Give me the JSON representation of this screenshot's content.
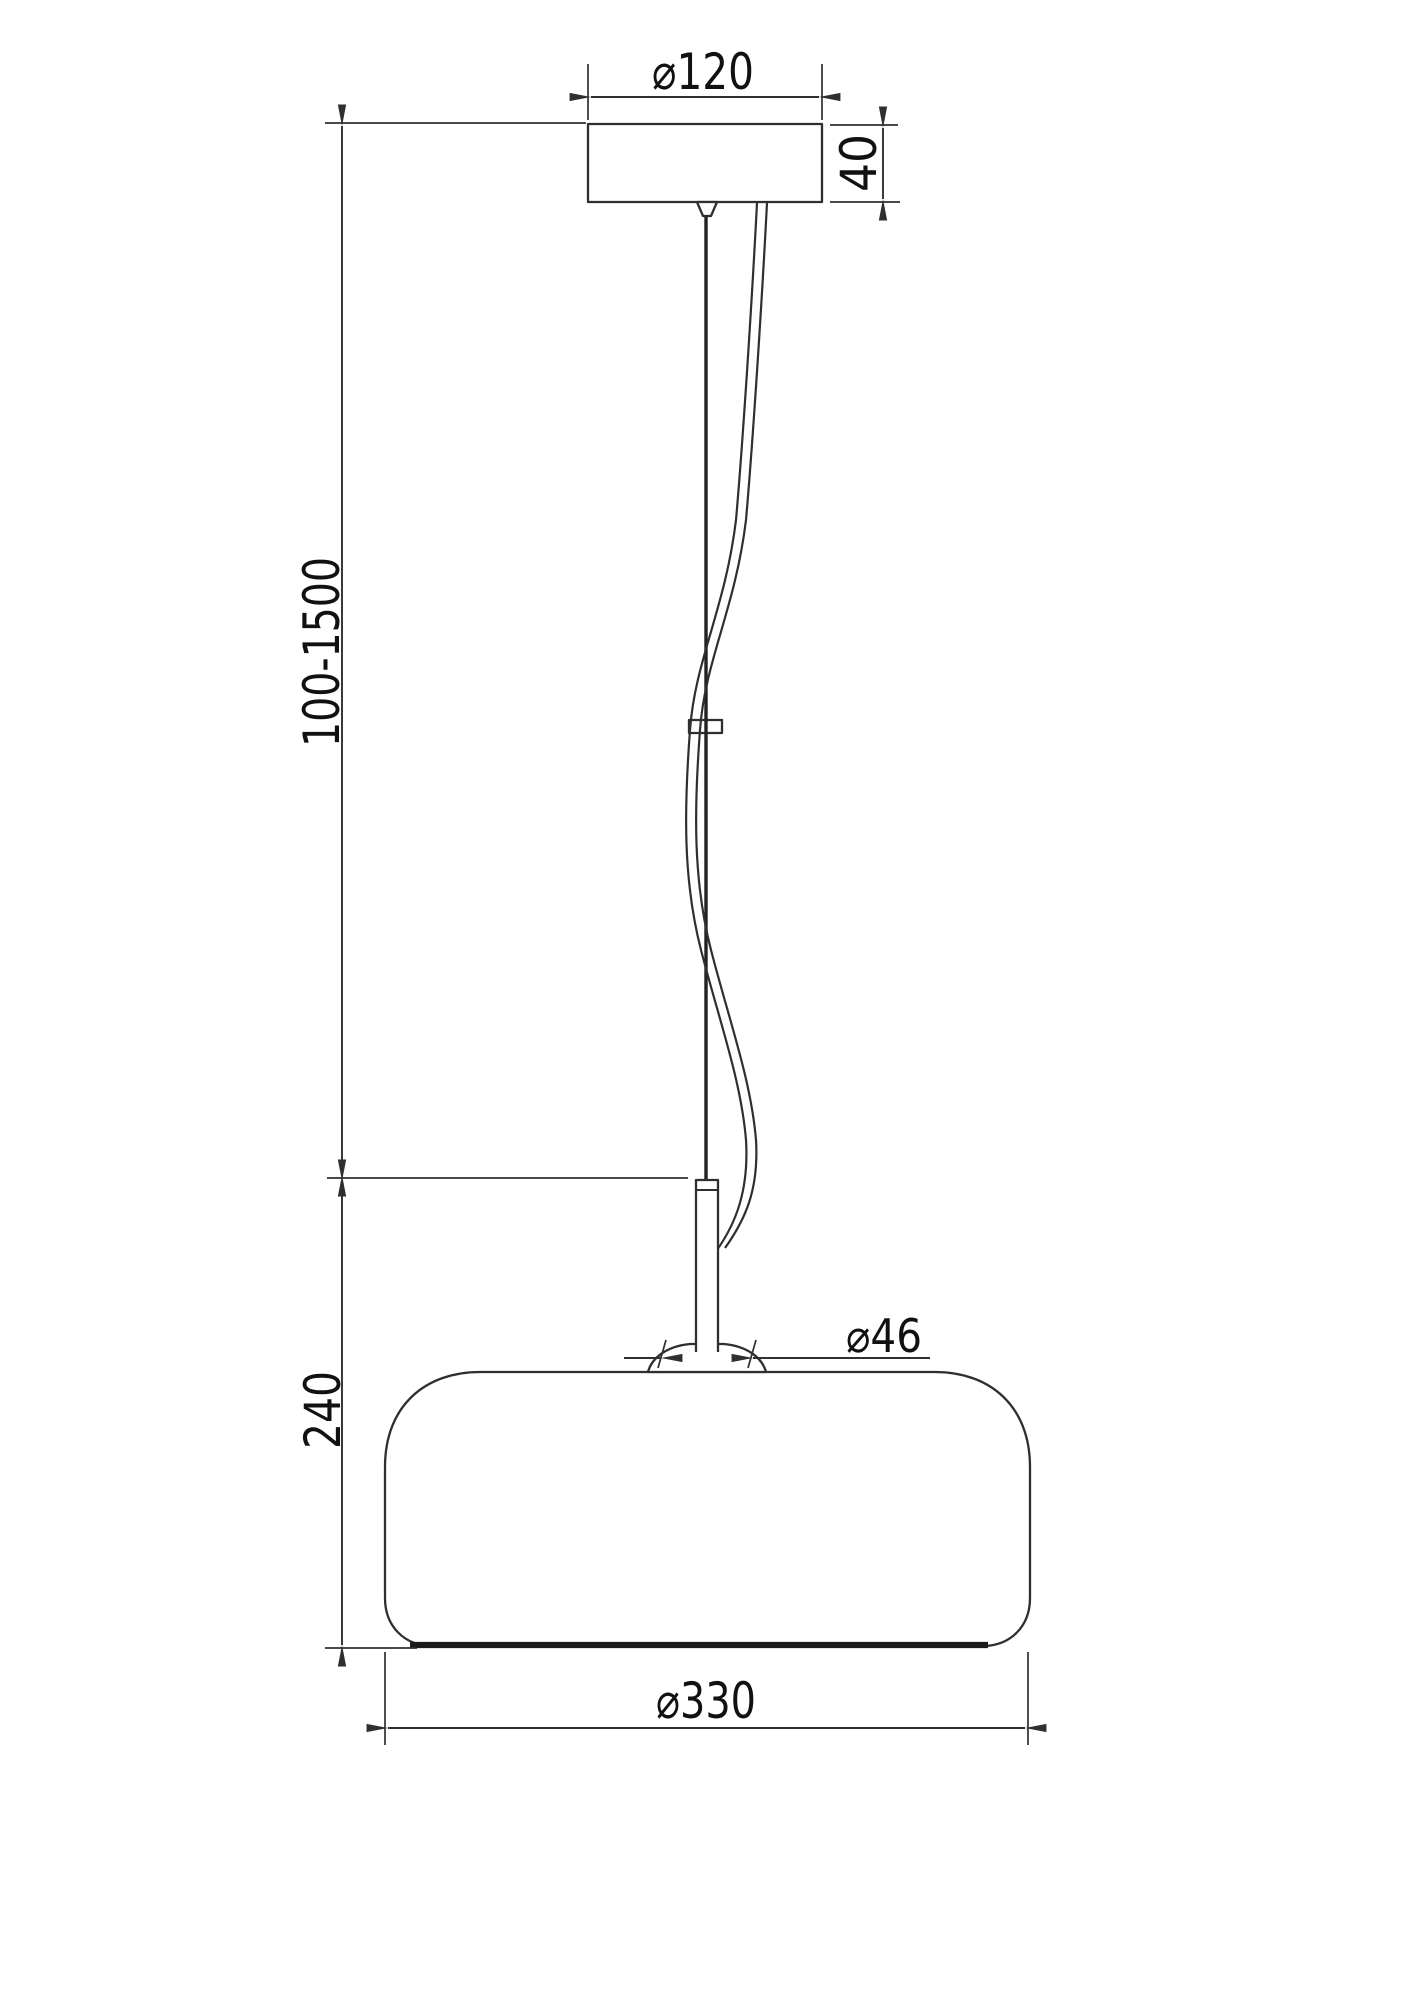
{
  "dimensions": {
    "canopy_diameter": "⌀120",
    "canopy_height": "40",
    "suspension_length": "100-1500",
    "shade_height": "240",
    "holder_diameter": "⌀46",
    "shade_diameter": "⌀330"
  },
  "colors": {
    "line": "#2f2f2f",
    "background": "#ffffff"
  }
}
